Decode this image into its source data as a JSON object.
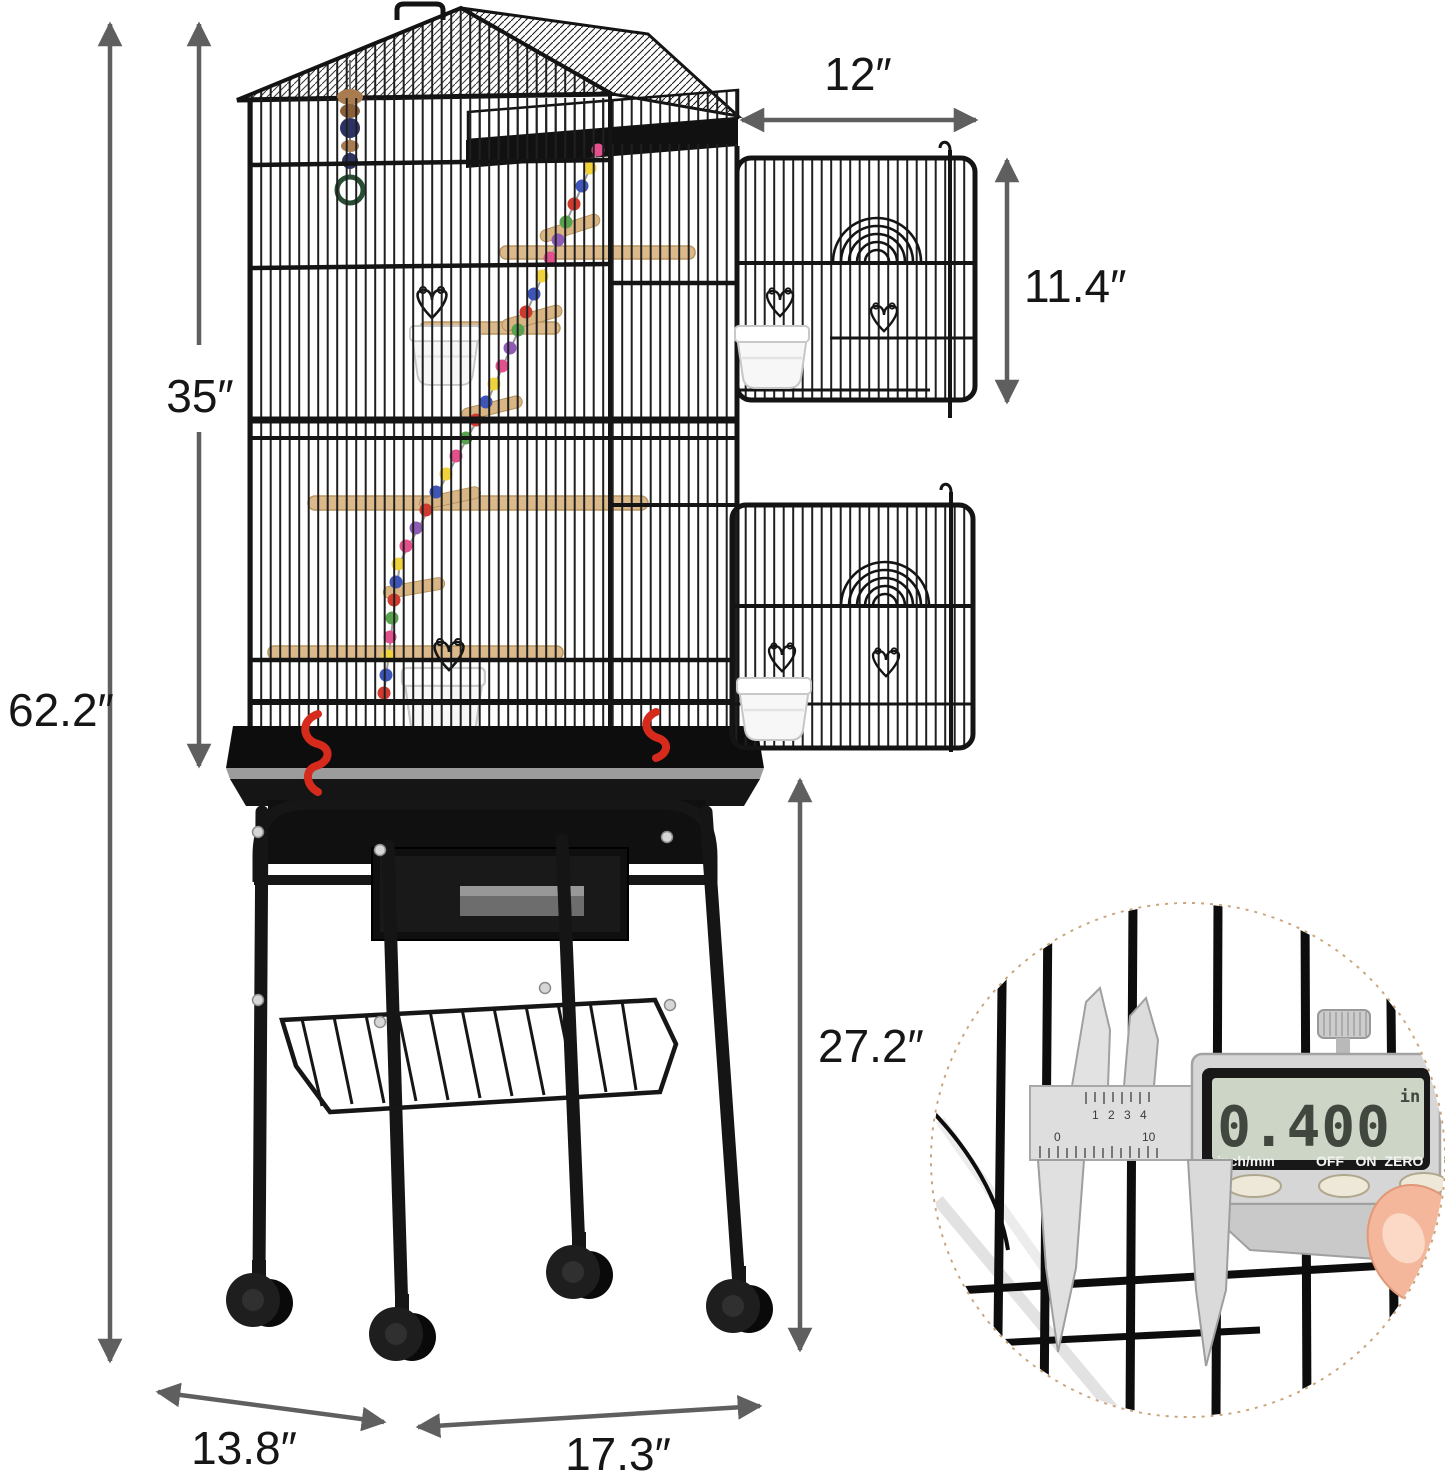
{
  "figure": {
    "type": "product-dimension-diagram",
    "subject": "roof-top bird cage with open doors, rolling stand and storage basket"
  },
  "dimensions": {
    "overall_height": "62.2″",
    "cage_height": "35″",
    "door_width": "12″",
    "door_height": "11.4″",
    "stand_height": "27.2″",
    "base_depth": "13.8″",
    "base_width": "17.3″"
  },
  "inset": {
    "display_value": "0.400",
    "display_unit": "in",
    "buttons": [
      "inch/mm",
      "OFF",
      "ON",
      "ZERO"
    ],
    "scale_top": "1 2 3 4",
    "scale_zero": "0",
    "scale_ten": "10"
  },
  "colors": {
    "arrow": "#5f5f5f",
    "label": "#161616",
    "cage": "#1b1b1b",
    "accent_red": "#d62b1c",
    "wood": "#d9b583",
    "inset_border": "#c9a57c",
    "lcd_screen": "#ccd5c6"
  }
}
